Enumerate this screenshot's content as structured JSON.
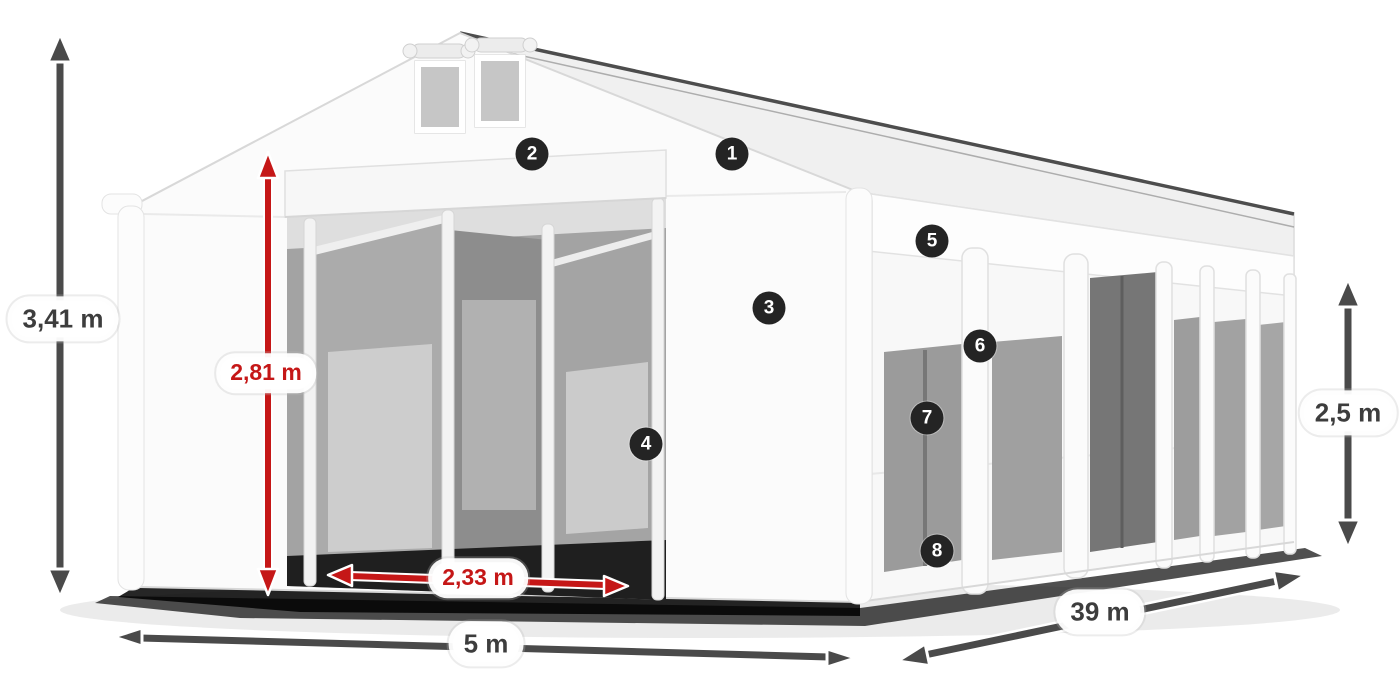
{
  "dimensions": {
    "total_height": "3,41 m",
    "entrance_height": "2,81 m",
    "entrance_width": "2,33 m",
    "gable_width": "5 m",
    "length": "39 m",
    "side_height": "2,5 m"
  },
  "callouts": {
    "badges": [
      "1",
      "2",
      "3",
      "4",
      "5",
      "6",
      "7",
      "8"
    ]
  },
  "colors": {
    "arrow_gray": "#4a4a4a",
    "accent_red": "#c51717",
    "label_text_gray": "#3d3d3d",
    "label_background": "#ffffff",
    "badge_background": "#242424",
    "badge_text": "#ffffff"
  }
}
